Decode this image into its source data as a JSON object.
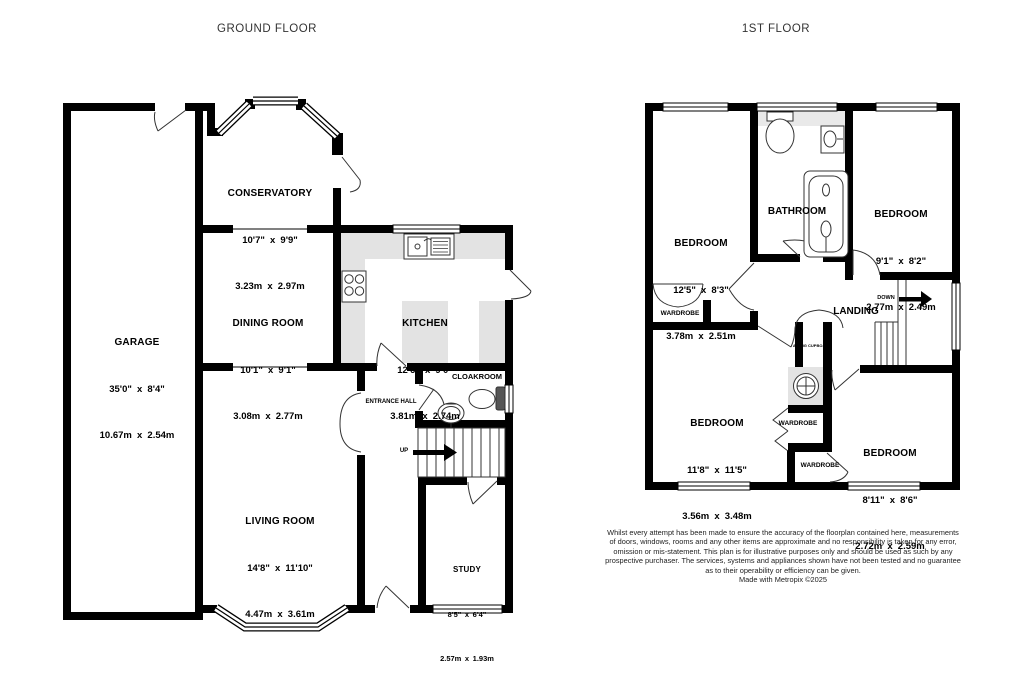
{
  "floors": {
    "ground": {
      "title": "GROUND FLOOR",
      "rooms": {
        "garage": {
          "name": "GARAGE",
          "dims_ft": "35'0\" x 8'4\"",
          "dims_m": "10.67m x 2.54m"
        },
        "conservatory": {
          "name": "CONSERVATORY",
          "dims_ft": "10'7\" x 9'9\"",
          "dims_m": "3.23m x 2.97m"
        },
        "dining": {
          "name": "DINING ROOM",
          "dims_ft": "10'1\" x 9'1\"",
          "dims_m": "3.08m x 2.77m"
        },
        "kitchen": {
          "name": "KITCHEN",
          "dims_ft": "12'6\" x 9'0\"",
          "dims_m": "3.81m x 2.74m"
        },
        "living": {
          "name": "LIVING ROOM",
          "dims_ft": "14'8\" x 11'10\"",
          "dims_m": "4.47m x 3.61m"
        },
        "study": {
          "name": "STUDY",
          "dims_ft": "8'5\" x 6'4\"",
          "dims_m": "2.57m x 1.93m"
        },
        "entrance_hall": {
          "name": "ENTRANCE HALL"
        },
        "cloakroom": {
          "name": "CLOAKROOM"
        },
        "stairs_up": {
          "name": "UP"
        }
      }
    },
    "first": {
      "title": "1ST FLOOR",
      "rooms": {
        "bedroom1": {
          "name": "BEDROOM",
          "dims_ft": "12'5\" x 8'3\"",
          "dims_m": "3.78m x 2.51m"
        },
        "bathroom": {
          "name": "BATHROOM"
        },
        "bedroom2": {
          "name": "BEDROOM",
          "dims_ft": "9'1\" x 8'2\"",
          "dims_m": "2.77m x 2.49m"
        },
        "landing": {
          "name": "LANDING"
        },
        "stairs_down": {
          "name": "DOWN"
        },
        "wardrobe1": {
          "name": "WARDROBE"
        },
        "wardrobe2": {
          "name": "WARDROBE"
        },
        "wardrobe3": {
          "name": "WARDROBE"
        },
        "airing_cupboard": {
          "name": "AIRING CUPBOARD"
        },
        "bedroom3": {
          "name": "BEDROOM",
          "dims_ft": "11'8\" x 11'5\"",
          "dims_m": "3.56m x 3.48m"
        },
        "bedroom4": {
          "name": "BEDROOM",
          "dims_ft": "8'11\" x 8'6\"",
          "dims_m": "2.72m x 2.59m"
        }
      }
    }
  },
  "disclaimer": {
    "lines": [
      "Whilst every attempt has been made to ensure the accuracy of the floorplan contained here, measurements",
      "of doors, windows, rooms and any other items are approximate and no responsibility is taken for any error,",
      "omission or mis-statement. This plan is for illustrative purposes only and should be used as such by any",
      "prospective purchaser. The services, systems and appliances shown have not been tested and no guarantee",
      "as to their operability or efficiency can be given.",
      "Made with Metropix ©2025"
    ]
  },
  "colors": {
    "wall": "#000000",
    "counter": "#e3e3e3",
    "fixture_stroke": "#333333"
  }
}
